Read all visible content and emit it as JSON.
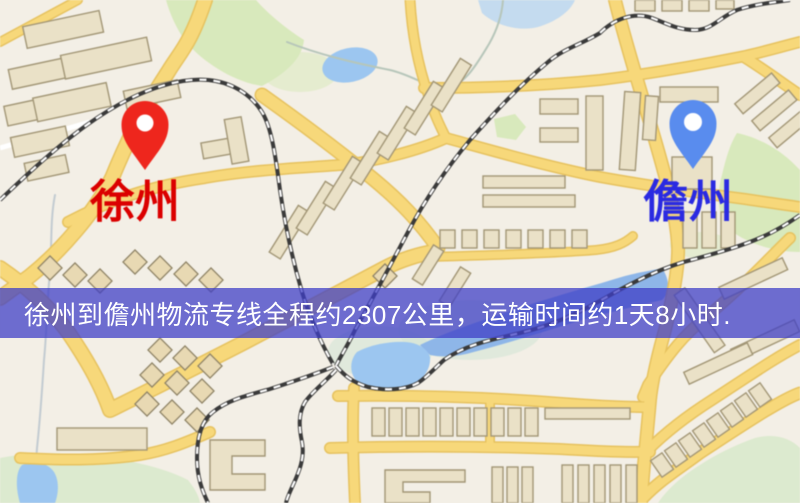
{
  "banner": {
    "text": "徐州到儋州物流专线全程约2307公里，运输时间约1天8小时.",
    "background_color": "#3e3ec6",
    "text_color": "#ffffff"
  },
  "route": {
    "origin_city": "徐州",
    "destination_city": "儋州",
    "distance_km": "2307",
    "duration": "1天8小时"
  },
  "map": {
    "origin": {
      "label": "徐州",
      "label_color": "#d40000",
      "pin_color": "#e8281f",
      "pin_icon": "red-map-pin"
    },
    "destination": {
      "label": "儋州",
      "label_color": "#2b2bdb",
      "pin_color": "#5b8cea",
      "pin_icon": "blue-map-pin"
    },
    "theme": {
      "background": "#f3efe6",
      "road_fill": "#f6d87e",
      "road_casing": "#e5c263",
      "park_green": "#d8e9bd",
      "water_blue": "#9dc6ee",
      "building_fill": "#eae1c8",
      "building_stroke": "#a29677",
      "railway_dark": "#3a3a3a"
    }
  }
}
